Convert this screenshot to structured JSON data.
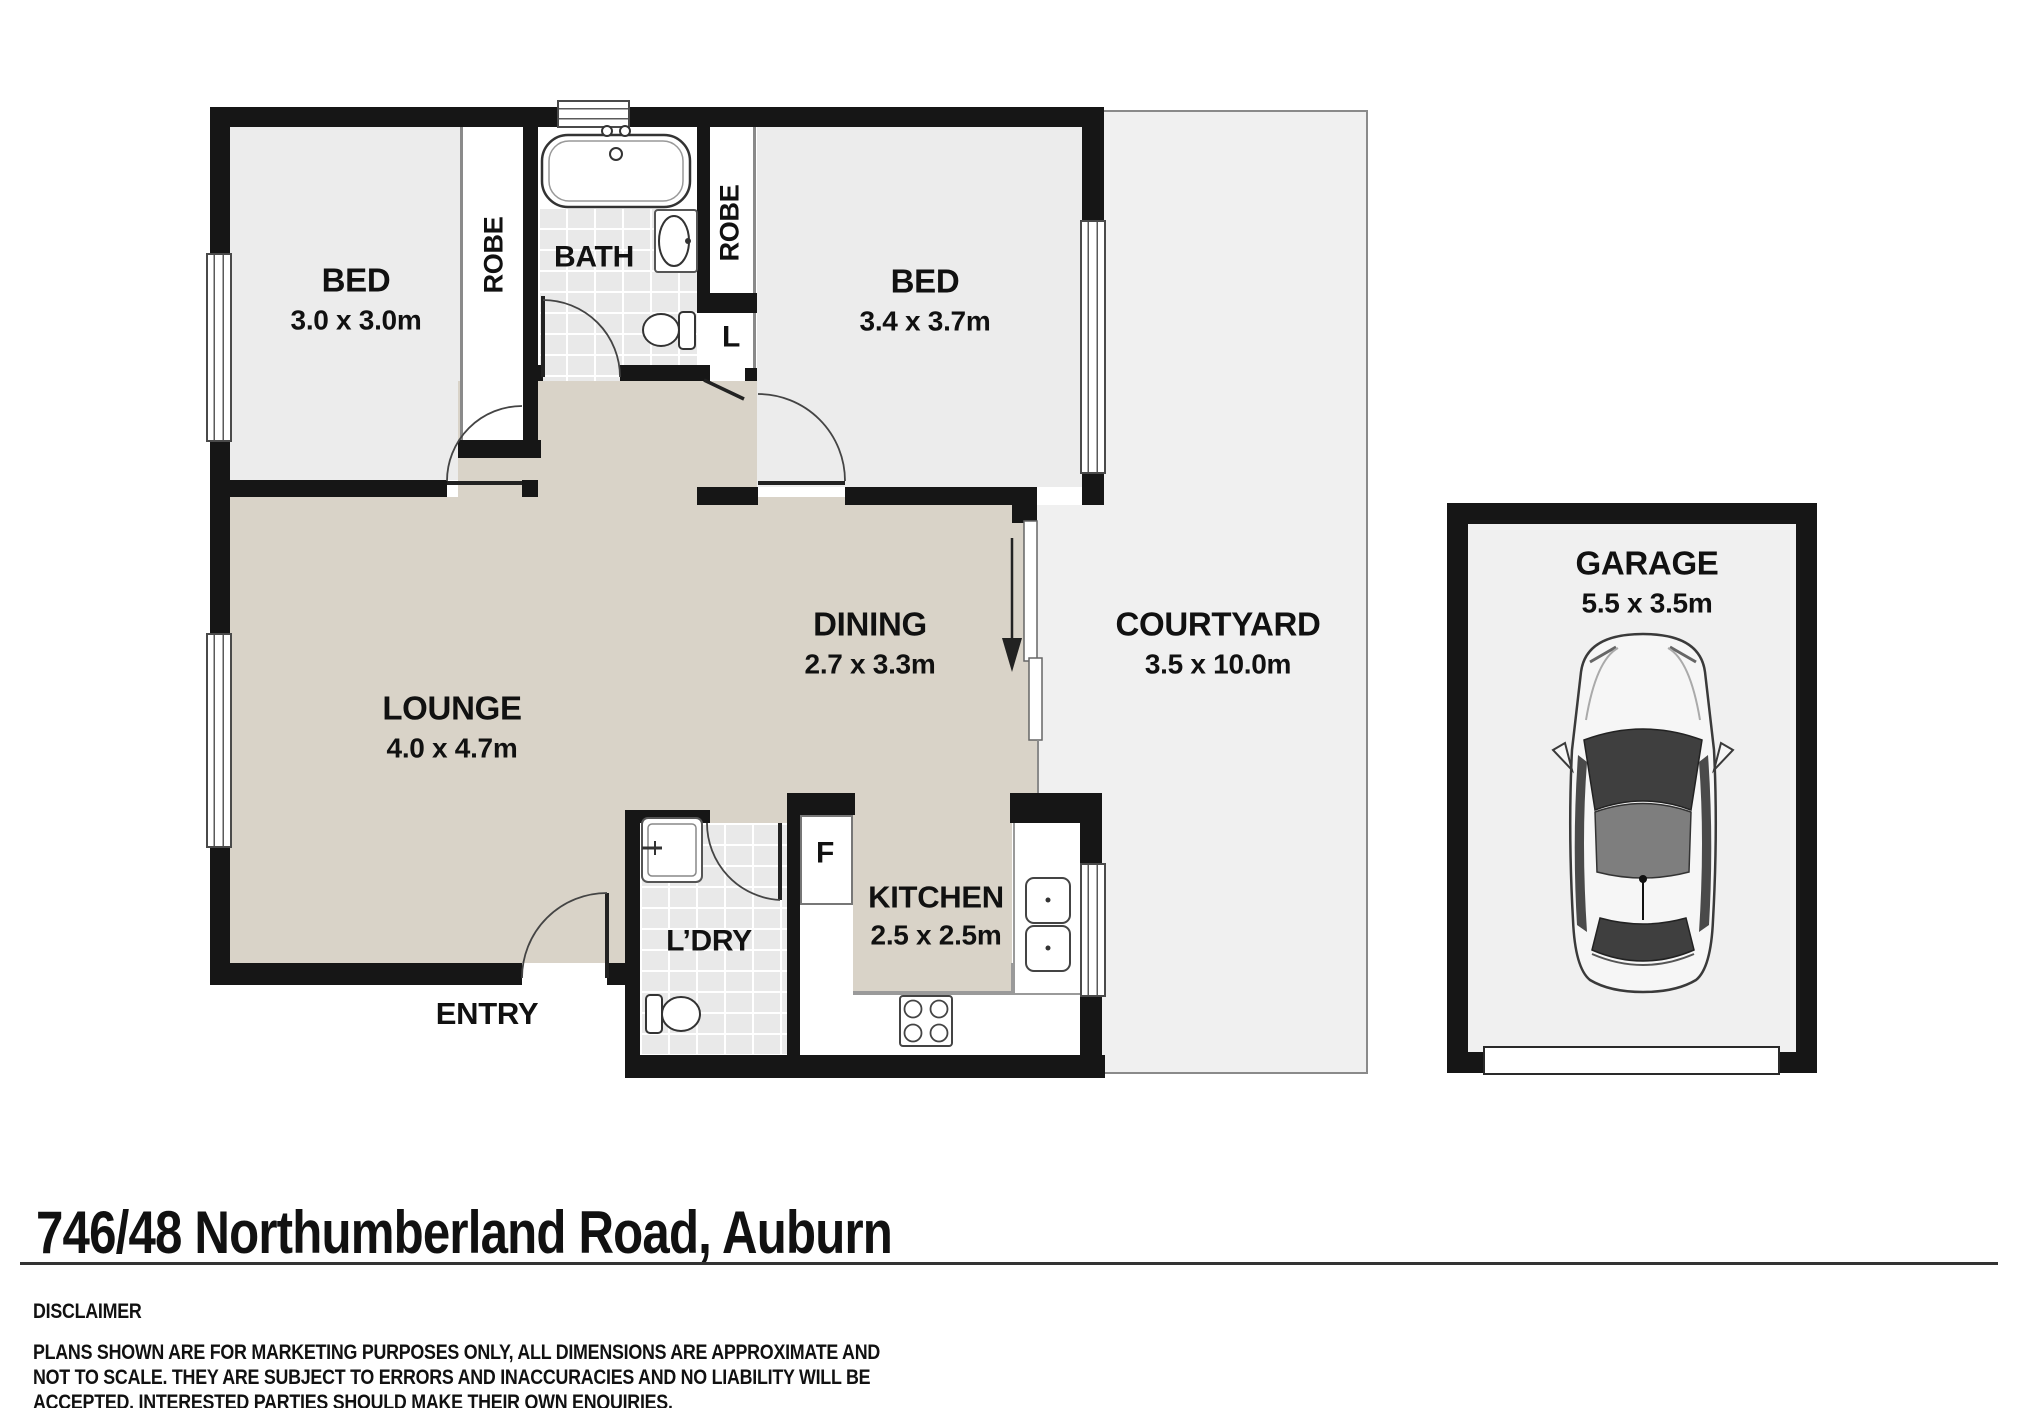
{
  "title": "746/48 Northumberland Road, Auburn",
  "disclaimer": {
    "heading": "DISCLAIMER",
    "line1": "PLANS SHOWN ARE FOR MARKETING PURPOSES ONLY, ALL DIMENSIONS ARE APPROXIMATE AND",
    "line2": "NOT TO SCALE. THEY ARE SUBJECT TO ERRORS AND INACCURACIES AND NO LIABILITY WILL BE",
    "line3": "ACCEPTED. INTERESTED PARTIES SHOULD MAKE THEIR OWN ENQUIRIES."
  },
  "rooms": {
    "bed1": {
      "name": "BED",
      "dims": "3.0 x 3.0m"
    },
    "bed2": {
      "name": "BED",
      "dims": "3.4 x 3.7m"
    },
    "lounge": {
      "name": "LOUNGE",
      "dims": "4.0 x 4.7m"
    },
    "dining": {
      "name": "DINING",
      "dims": "2.7 x 3.3m"
    },
    "kitchen": {
      "name": "KITCHEN",
      "dims": "2.5 x 2.5m"
    },
    "courtyard": {
      "name": "COURTYARD",
      "dims": "3.5 x 10.0m"
    },
    "garage": {
      "name": "GARAGE",
      "dims": "5.5 x 3.5m"
    },
    "bath": {
      "name": "BATH"
    },
    "laundry": {
      "name": "L’DRY"
    },
    "entry": {
      "name": "ENTRY"
    },
    "robe_left": {
      "name": "ROBE"
    },
    "robe_right": {
      "name": "ROBE"
    },
    "linen": {
      "name": "L"
    },
    "fridge": {
      "name": "F"
    }
  },
  "colors": {
    "wall": "#161616",
    "living_floor": "#d9d3c8",
    "room_floor": "#ececec",
    "outdoor_floor": "#f0f0f0",
    "tile_floor": "#e9e9e9"
  }
}
